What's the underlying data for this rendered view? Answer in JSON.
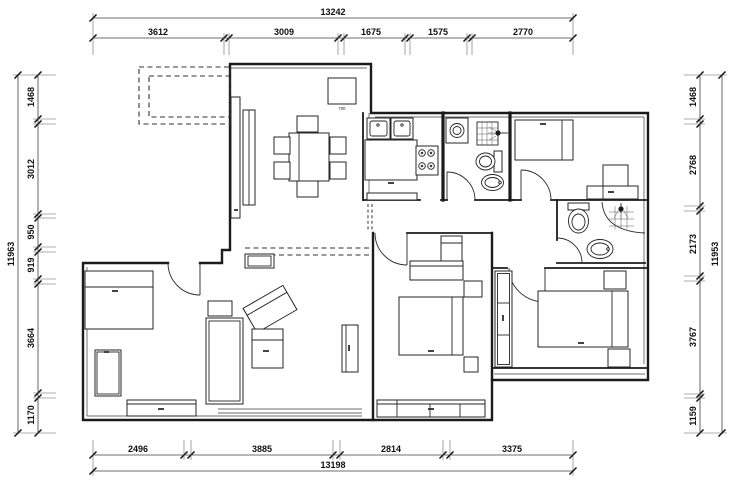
{
  "plan": {
    "background": "#ffffff",
    "ink": "#1c1c1c",
    "dimensions": {
      "top": {
        "total": "13242",
        "segments": [
          "3612",
          "3009",
          "1675",
          "1575",
          "2770"
        ]
      },
      "bottom": {
        "total": "13198",
        "segments": [
          "2496",
          "3885",
          "2814",
          "3375"
        ]
      },
      "left": {
        "total": "11963",
        "segments": [
          "1468",
          "3012",
          "950",
          "919",
          "3664",
          "1170"
        ]
      },
      "right": {
        "total": "11953",
        "segments": [
          "1468",
          "2768",
          "2173",
          "3767",
          "1159"
        ]
      }
    },
    "furniture_labels": {
      "fridge_width": "700"
    }
  }
}
